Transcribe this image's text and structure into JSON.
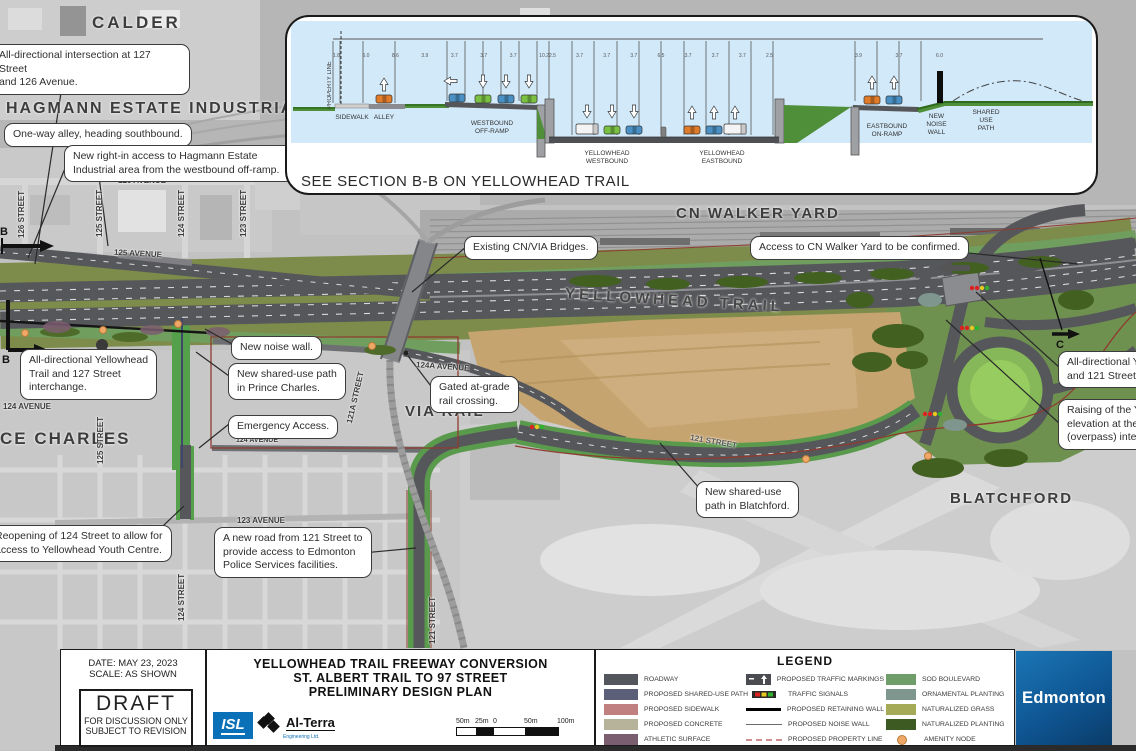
{
  "colors": {
    "roadway": "#55565b",
    "olive_boulevard": "#7d8c4a",
    "sod": "#6f9e5f",
    "bright_green": "#55a04b",
    "tan_field": "#c6a46f",
    "sky": "#d2e9f9",
    "red_property": "#8f3b2f",
    "amenity": "#f0a868",
    "signal_red": "#dd2222",
    "signal_yellow": "#e8c820",
    "signal_green": "#2db32d",
    "edmonton_blue": "#0f5694",
    "isl_blue": "#0a70b8"
  },
  "inset": {
    "caption": "SEE SECTION B-B ON YELLOWHEAD TRAIL",
    "property_line": "PROPERTY LINE",
    "labels": {
      "sidewalk": "SIDEWALK",
      "alley": "ALLEY",
      "wb_offramp": "WESTBOUND\nOFF-RAMP",
      "yh_wb": "YELLOWHEAD\nWESTBOUND",
      "yh_eb": "YELLOWHEAD\nEASTBOUND",
      "eb_onramp": "EASTBOUND\nON-RAMP",
      "noise_wall": "NEW\nNOISE\nWALL",
      "shared_use": "SHARED\nUSE\nPATH"
    },
    "dims": {
      "left": [
        "1.8",
        "6.0",
        "8.6",
        "3.9",
        "3.7",
        "3.7",
        "3.7",
        "10.2"
      ],
      "mid": [
        "2.5",
        "3.7",
        "3.7",
        "3.7",
        "6.5",
        "3.7",
        "3.7",
        "3.7",
        "2.5"
      ],
      "right": [
        "3.9",
        "3.7",
        "6.0"
      ]
    }
  },
  "map": {
    "areas": {
      "calder": "CALDER",
      "hagmann": "HAGMANN ESTATE INDUSTRIAL",
      "cn_walker": "CN WALKER YARD",
      "via_rail": "VIA RAIL",
      "blatchford": "BLATCHFORD",
      "prince_charles": "CE CHARLES",
      "yellowhead_trail": "YELLOWHEAD TRAIL"
    },
    "streets": [
      "126 AVENUE",
      "125 AVENUE",
      "126 STREET",
      "125 STREET",
      "124 STREET",
      "123 STREET",
      "124 AVENUE",
      "125 STREET",
      "124A AVENUE",
      "121A STREET",
      "124 AVENUE",
      "123 AVENUE",
      "124 STREET",
      "121 STREET",
      "121 STREET"
    ],
    "callouts": [
      "All-directional intersection at 127 Street\nand 126 Avenue.",
      "One-way alley, heading southbound.",
      "New right-in access to Hagmann Estate\nIndustrial area from the westbound off-ramp.",
      "Existing CN/VIA Bridges.",
      "Access to CN Walker Yard to be confirmed.",
      "New noise wall.",
      "New shared-use path\nin Prince Charles.",
      "Gated at-grade\nrail crossing.",
      "Emergency Access.",
      "Reopening of 124 Street to allow for\naccess to Yellowhead Youth Centre.",
      "A new road from 121 Street  to\nprovide access to Edmonton\nPolice Services facilities.",
      "New shared-use\npath in Blatchford.",
      "All-directional Yellowhead Trail\nand 121 Street interchange.",
      "Raising of the Yellowhead Trail\nelevation at the 121 Street\n(overpass) interchange.",
      "All-directional Yellowhead\nTrail and 127 Street\ninterchange."
    ],
    "markers": {
      "b": "B",
      "c": "C"
    }
  },
  "legend": {
    "title": "LEGEND",
    "col1": [
      {
        "label": "ROADWAY",
        "color": "#54565e"
      },
      {
        "label": "PROPOSED SHARED-USE PATH",
        "color": "#5b6078"
      },
      {
        "label": "PROPOSED SIDEWALK",
        "color": "#c08080"
      },
      {
        "label": "PROPOSED CONCRETE",
        "color": "#b7b29a"
      },
      {
        "label": "ATHLETIC SURFACE",
        "color": "#7c5e71"
      }
    ],
    "col2": [
      {
        "label": "PROPOSED TRAFFIC MARKINGS"
      },
      {
        "label": "TRAFFIC SIGNALS"
      },
      {
        "label": "PROPOSED RETAINING WALL"
      },
      {
        "label": "PROPOSED NOISE WALL"
      },
      {
        "label": "PROPOSED PROPERTY LINE"
      }
    ],
    "col3": [
      {
        "label": "SOD BOULEVARD",
        "color": "#6f9e6a"
      },
      {
        "label": "ORNAMENTAL PLANTING",
        "color": "#7e968e"
      },
      {
        "label": "NATURALIZED GRASS",
        "color": "#a4aa58"
      },
      {
        "label": "NATURALIZED PLANTING",
        "color": "#3d5a22"
      },
      {
        "label": "AMENITY NODE",
        "color": "#f0a868"
      }
    ]
  },
  "titleblock": {
    "date_line": "DATE: MAY 23, 2023",
    "scale_line": "SCALE: AS SHOWN",
    "draft": "DRAFT",
    "draft_sub1": "FOR DISCUSSION ONLY",
    "draft_sub2": "SUBJECT TO REVISION",
    "title_line1": "YELLOWHEAD TRAIL FREEWAY CONVERSION",
    "title_line2": "ST. ALBERT TRAIL TO 97 STREET",
    "title_line3": "PRELIMINARY DESIGN PLAN",
    "isl": "ISL",
    "alterra": "Al-Terra",
    "alterra_sub": "Engineering Ltd.",
    "scalebar": [
      "50m",
      "25m",
      "0",
      "50m",
      "100m"
    ],
    "edmonton": "Edmonton"
  }
}
